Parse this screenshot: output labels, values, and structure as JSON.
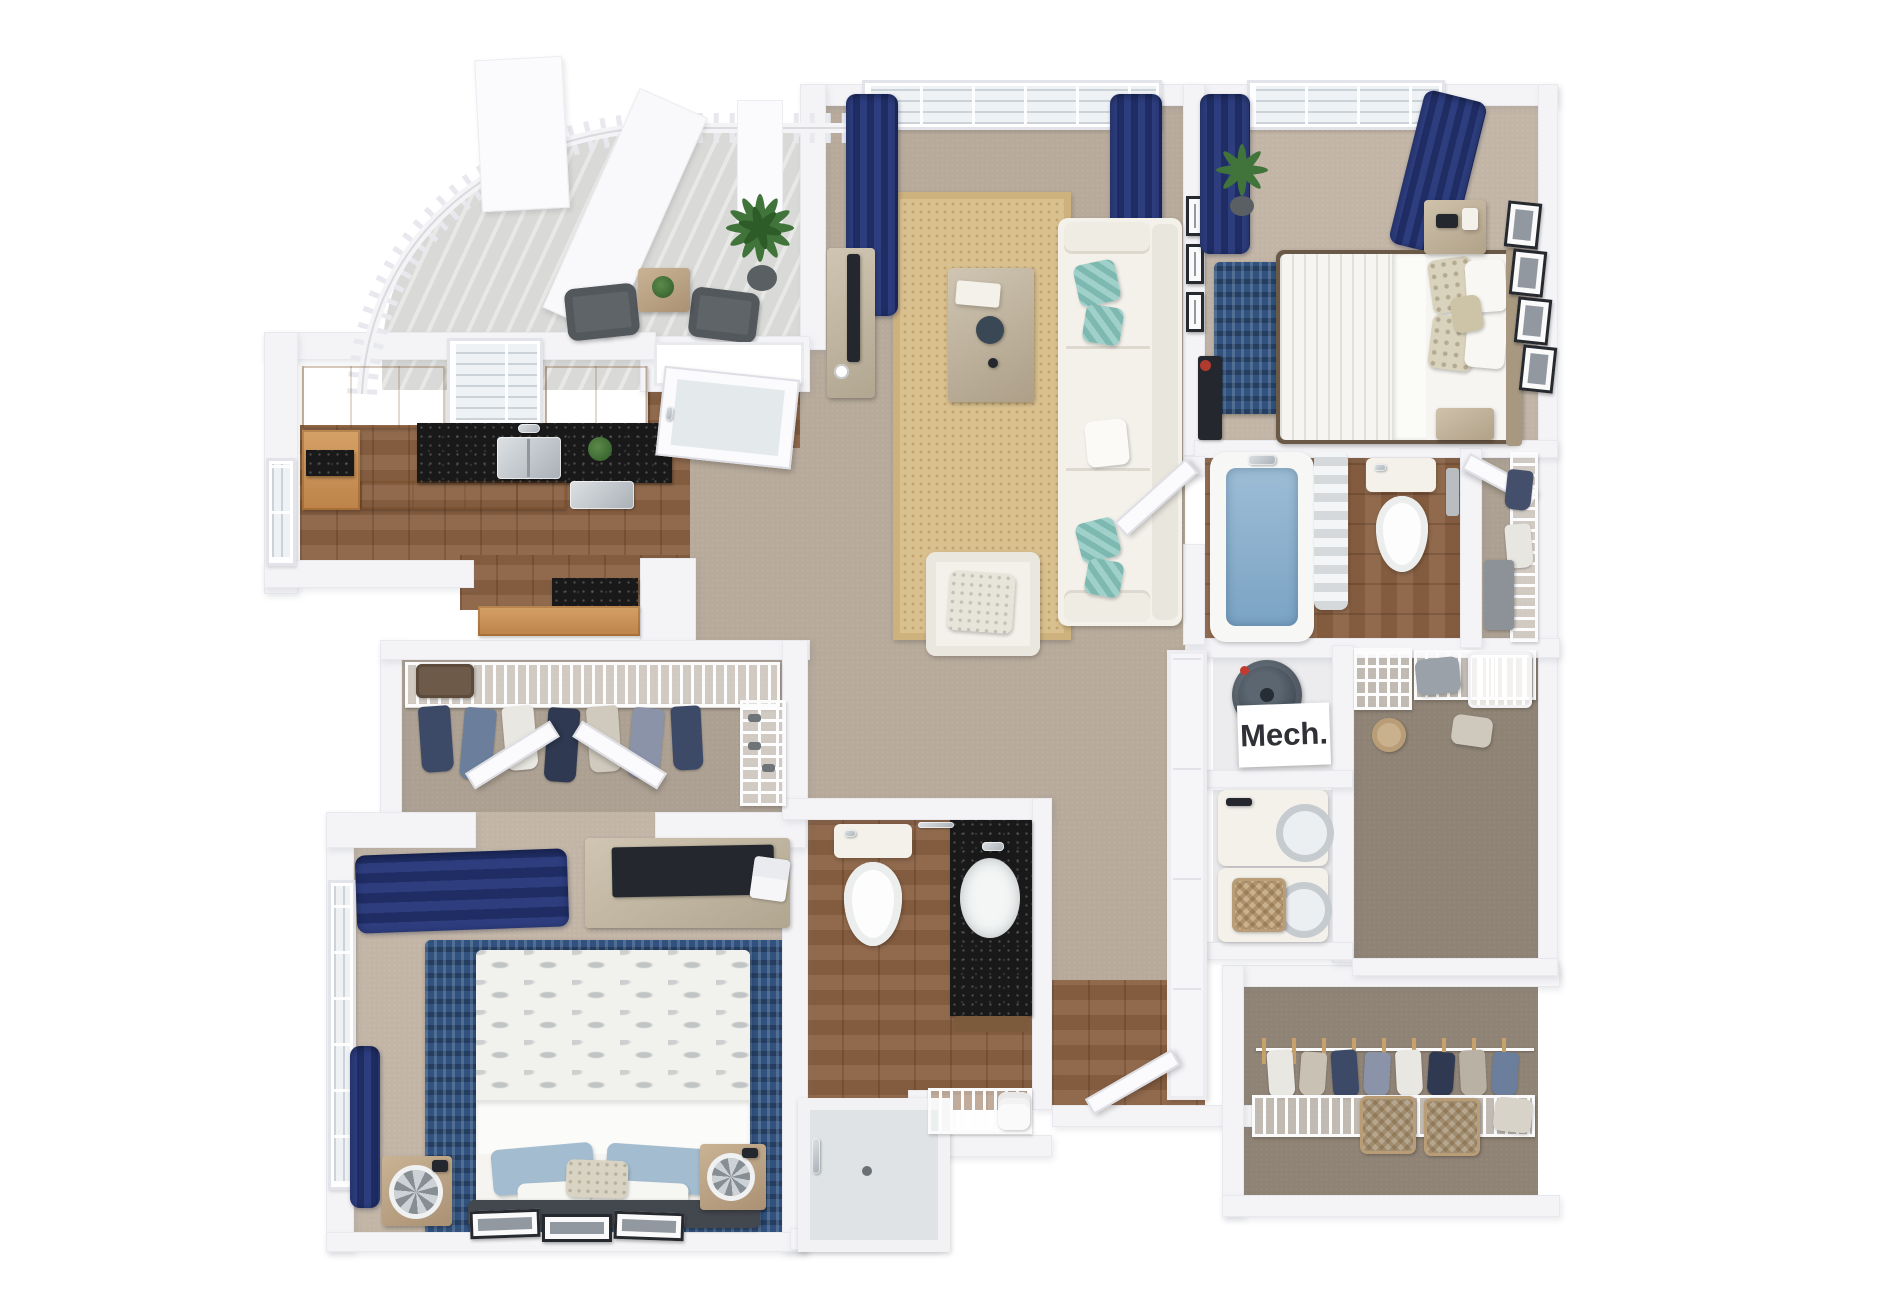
{
  "floor_plan": {
    "type": "3d-apartment-floor-plan-render",
    "labels": {
      "mech_closet": "Mech."
    },
    "palette": {
      "background": "#ffffff",
      "wall": "#f4f4f7",
      "carpet_living": "#b7aa9b",
      "carpet_bedroom": "#c2b5a6",
      "carpet_closet": "#8f8375",
      "wood_floor": "#8a6142",
      "kitchen_cabinet": "#c79055",
      "countertop_granite": "#191919",
      "curtain_navy": "#24336f",
      "rug_navy": "#31527e",
      "rug_jute": "#d9c08f",
      "sofa_white": "#f3f1ea",
      "pillow_teal": "#8fc4bd",
      "bedding_sage": "#b9c8b4",
      "tub_blue": "#84abc9",
      "balcony_concrete": "#d9dad7"
    }
  }
}
